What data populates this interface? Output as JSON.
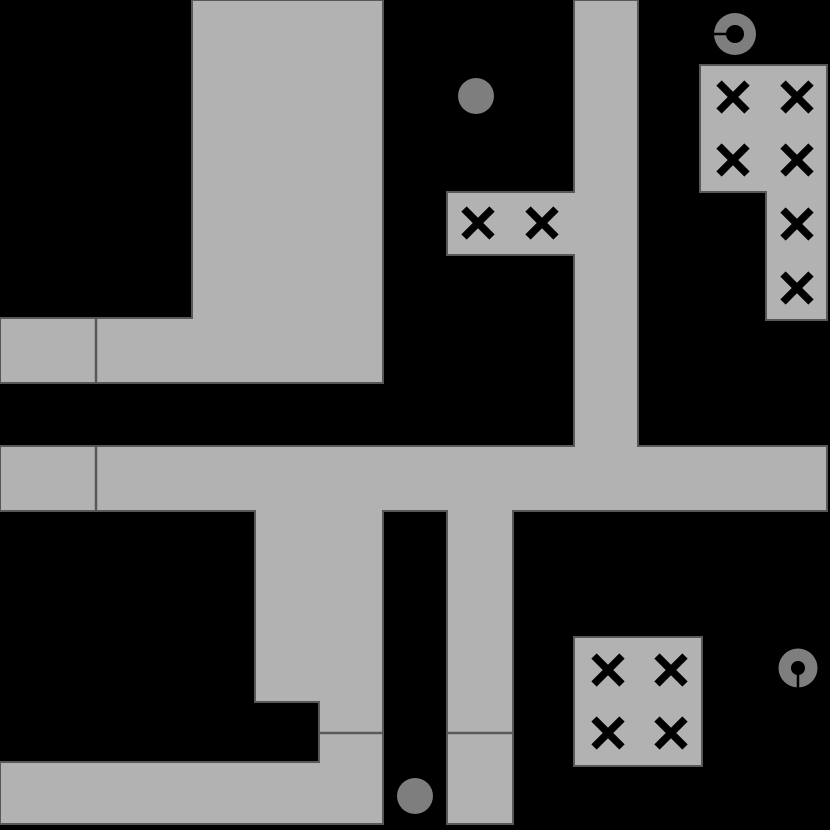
{
  "canvas": {
    "width": 830,
    "height": 830,
    "background": "#000000"
  },
  "style": {
    "room_fill": "#b2b2b2",
    "room_stroke": "#585858",
    "room_stroke_width": 2,
    "divider_color": "#585858",
    "divider_width": 2.5,
    "x_color": "#000000",
    "x_half_size": 14,
    "x_stroke_width": 7.5,
    "token_fill": "#7e7e7e",
    "hole_fill": "#000000",
    "pointer_width": 2.5
  },
  "rooms": [
    {
      "name": "top-left",
      "points": [
        [
          192,
          0
        ],
        [
          383,
          0
        ],
        [
          383,
          383
        ],
        [
          0,
          383
        ],
        [
          0,
          318
        ],
        [
          192,
          318
        ]
      ]
    },
    {
      "name": "corridor-network",
      "points": [
        [
          574,
          0
        ],
        [
          638,
          0
        ],
        [
          638,
          446
        ],
        [
          827,
          446
        ],
        [
          827,
          511
        ],
        [
          513,
          511
        ],
        [
          513,
          824
        ],
        [
          447,
          824
        ],
        [
          447,
          511
        ],
        [
          383,
          511
        ],
        [
          383,
          824
        ],
        [
          0,
          824
        ],
        [
          0,
          762
        ],
        [
          319,
          762
        ],
        [
          319,
          702
        ],
        [
          255,
          702
        ],
        [
          255,
          511
        ],
        [
          0,
          511
        ],
        [
          0,
          446
        ],
        [
          574,
          446
        ],
        [
          574,
          255
        ],
        [
          447,
          255
        ],
        [
          447,
          192
        ],
        [
          574,
          192
        ]
      ]
    },
    {
      "name": "top-right",
      "points": [
        [
          700,
          65
        ],
        [
          827,
          65
        ],
        [
          827,
          320
        ],
        [
          766,
          320
        ],
        [
          766,
          192
        ],
        [
          700,
          192
        ]
      ]
    },
    {
      "name": "bottom-right",
      "points": [
        [
          574,
          637
        ],
        [
          702,
          637
        ],
        [
          702,
          766
        ],
        [
          574,
          766
        ]
      ]
    }
  ],
  "dividers": [
    {
      "x1": 96,
      "y1": 318,
      "x2": 96,
      "y2": 383
    },
    {
      "x1": 96,
      "y1": 446,
      "x2": 96,
      "y2": 511
    },
    {
      "x1": 319,
      "y1": 733,
      "x2": 383,
      "y2": 733
    },
    {
      "x1": 447,
      "y1": 733,
      "x2": 513,
      "y2": 733
    }
  ],
  "x_marks": [
    {
      "x": 478,
      "y": 223
    },
    {
      "x": 542,
      "y": 223
    },
    {
      "x": 733,
      "y": 97
    },
    {
      "x": 797,
      "y": 97
    },
    {
      "x": 733,
      "y": 160
    },
    {
      "x": 797,
      "y": 160
    },
    {
      "x": 797,
      "y": 224
    },
    {
      "x": 797,
      "y": 288
    },
    {
      "x": 608,
      "y": 670
    },
    {
      "x": 671,
      "y": 670
    },
    {
      "x": 608,
      "y": 733
    },
    {
      "x": 671,
      "y": 733
    }
  ],
  "solid_tokens": [
    {
      "cx": 476,
      "cy": 96,
      "r": 18
    },
    {
      "cx": 415,
      "cy": 796,
      "r": 18
    }
  ],
  "ring_tokens": [
    {
      "cx": 735,
      "cy": 34,
      "r": 21,
      "hole_r": 9,
      "direction": "left"
    },
    {
      "cx": 798,
      "cy": 668,
      "r": 19.5,
      "hole_r": 7,
      "direction": "down"
    }
  ]
}
